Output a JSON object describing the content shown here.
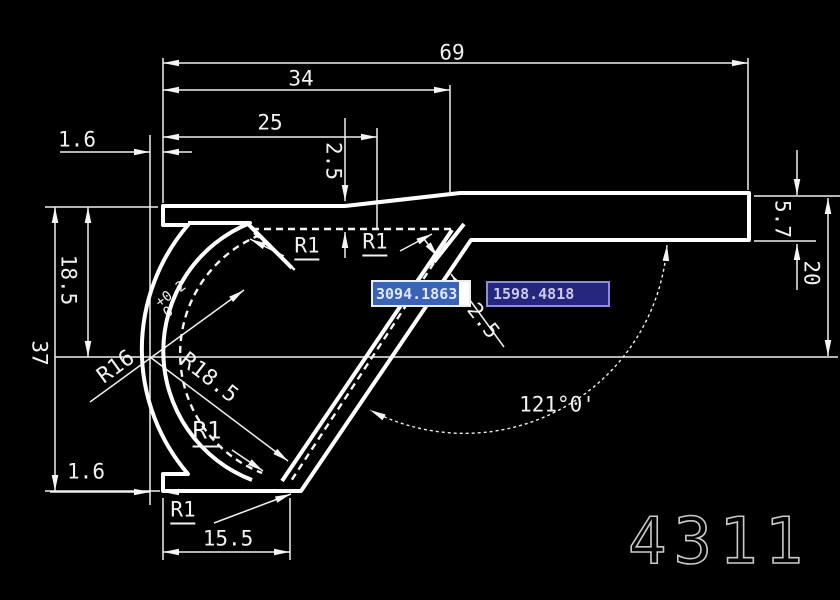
{
  "app": {
    "background": "#000000",
    "line_color": "#f5f5f5"
  },
  "watermark": {
    "text": "4311",
    "color": "#c9c9c9"
  },
  "coordinate_inputs": {
    "x_field": {
      "value": "3094.1863",
      "state": "selected",
      "selection_color": "#3a63b5",
      "field_bg": "#ffffff",
      "text_color": "#dfe9ff"
    },
    "y_field": {
      "value": "1598.4818",
      "state": "normal",
      "field_bg": "#26267e",
      "border_color": "#8b8fd9",
      "text_color": "#c9c9ea"
    }
  },
  "dimensions": {
    "width_69": "69",
    "width_34": "34",
    "width_25": "25",
    "groove_depth_2_5": "2.5",
    "left_1_6_top": "1.6",
    "left_1_6_bottom": "1.6",
    "height_18_5": "18.5",
    "height_37": "37",
    "width_15_5": "15.5",
    "right_5_7": "5.7",
    "right_20": "20",
    "wall_thickness_2_5": "2.5",
    "angle_121": "121°0'",
    "radius_r16": "R16",
    "r16_tol_upper": "+0.2",
    "r16_tol_lower": "0",
    "radius_r18_5": "R18.5",
    "radius_r1_groove_left": "R1",
    "radius_r1_groove_right": "R1",
    "radius_r1_arc": "R1",
    "radius_r1_bottom": "R1"
  }
}
